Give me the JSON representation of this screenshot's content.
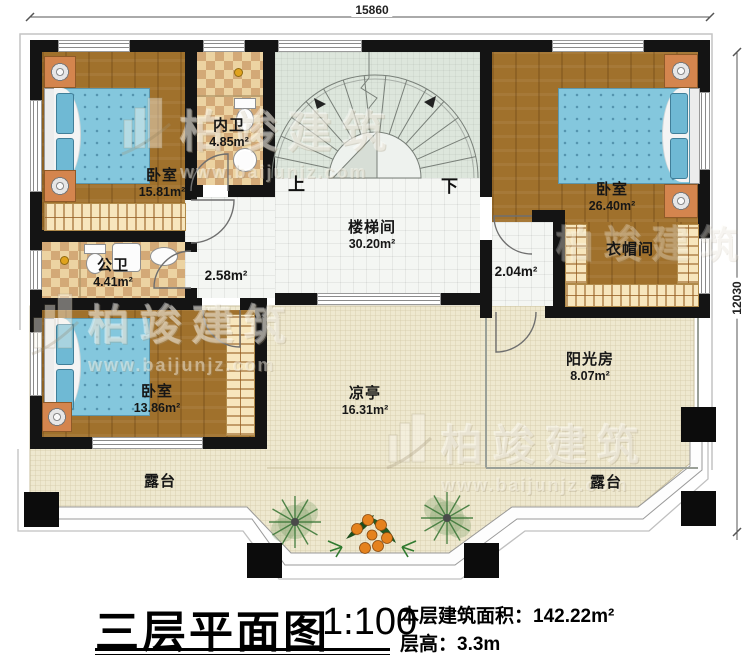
{
  "title_block": {
    "title": "三层平面图",
    "scale": "1:100",
    "area_label": "本层建筑面积：",
    "area_value": "142.22m²",
    "floor_height_label": "层高：",
    "floor_height_value": "3.3m"
  },
  "dimensions": {
    "top_width": "15860",
    "right_height": "12030"
  },
  "rooms": {
    "bedroom1": {
      "name": "卧室",
      "area": "15.81m²"
    },
    "inner_bath": {
      "name": "内卫",
      "area": "4.85m²"
    },
    "public_bath": {
      "name": "公卫",
      "area": "4.41m²"
    },
    "stairwell": {
      "name": "楼梯间",
      "area": "30.20m²"
    },
    "bedroom2": {
      "name": "卧室",
      "area": "26.40m²"
    },
    "cloakroom": {
      "name": "衣帽间"
    },
    "bedroom3": {
      "name": "卧室",
      "area": "13.86m²"
    },
    "pavilion": {
      "name": "凉亭",
      "area": "16.31m²"
    },
    "sunroom": {
      "name": "阳光房",
      "area": "8.07m²"
    },
    "terrace_left": {
      "name": "露台"
    },
    "terrace_right": {
      "name": "露台"
    }
  },
  "halls": {
    "h258": {
      "area": "2.58m²"
    },
    "h204": {
      "area": "2.04m²"
    }
  },
  "stairs": {
    "up_label": "上",
    "down_label": "下"
  },
  "watermark": {
    "brand": "柏竣建筑",
    "url": "www.baijunjz.com"
  },
  "colors": {
    "wall": "#141414",
    "wood": "#a0712c",
    "tile_checker": "#d3a977",
    "terrace": "#eee8cf",
    "stair_bg": "#dde6dc",
    "bed": "#84c7dd",
    "nightstand": "#d4854e",
    "column": "#0c0c0c"
  }
}
